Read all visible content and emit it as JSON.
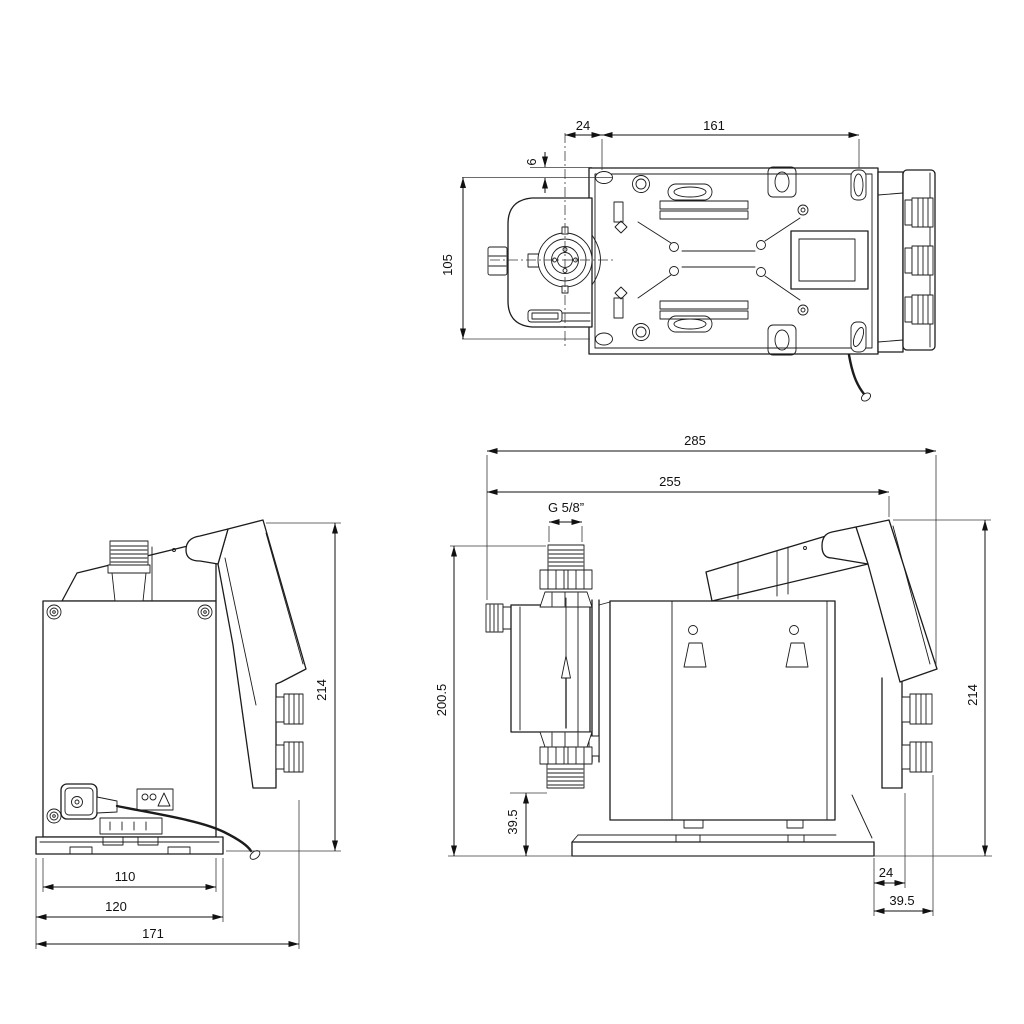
{
  "views": {
    "top": {
      "d24": "24",
      "d161": "161",
      "d6": "6",
      "d105": "105"
    },
    "front": {
      "d110": "110",
      "d120": "120",
      "d171": "171",
      "d214": "214"
    },
    "side": {
      "d285": "285",
      "d255": "255",
      "thread": "G 5/8”",
      "d200_5": "200.5",
      "d39_5_side": "39.5",
      "d214": "214",
      "d24": "24",
      "d39_5_bottom": "39.5"
    }
  },
  "style": {
    "line_color": "#1c1c1c",
    "dim_color": "#111111",
    "background": "#ffffff"
  }
}
